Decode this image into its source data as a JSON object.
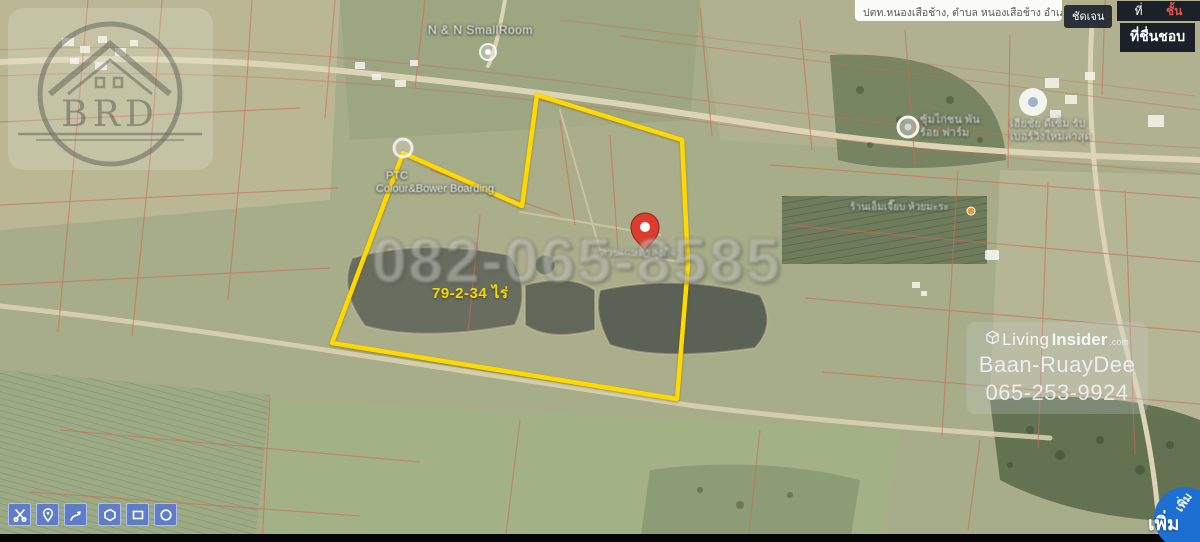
{
  "topbar": {
    "search_text": "ปตท.หนองเสือช้าง, ตำบล หนองเสือช้าง อำเภอ",
    "clear_button": "ชัดเจน",
    "layer_tab_left": "ที่",
    "layer_tab_right": "ชั้น",
    "favorites_button": "ที่ชื่นชอบ"
  },
  "map": {
    "pin_color": "#dd3b2e",
    "poi": {
      "smallroom": "N & N SmallRoom",
      "ptc_line1": "PTC",
      "ptc_line2": "Colour&Bower Boarding",
      "chicken_line1": "ซุ้มไก่ชน พัน",
      "chicken_line2": "ร้อย ฟาร์ม",
      "right_line1": "เฮียชัย ดีเซิ่ม รับ",
      "right_line2": "เบอร์วิ่งใหม่ล่าสุด",
      "shop": "ร้านเอ็มเจี๊ยบ ห้วยมะระ",
      "pin_label": "สวนเกษตรลุงกิจ"
    },
    "parcel": {
      "area_label": "79-2-34 ไร่",
      "outline_color": "#ffd900",
      "outline_points": "537,95 682,140 688,265 677,399 332,343 403,153 522,206"
    }
  },
  "watermarks": {
    "brd_logo": "BRD",
    "phone_overlay": "082-065-8585",
    "brand_light": "Living",
    "brand_bold": "Insider",
    "brand_tld": ".com",
    "agent_name": "Baan-RuayDee",
    "agent_phone": "065-253-9924"
  },
  "tools": {
    "add_button": "เพิ่ม"
  }
}
